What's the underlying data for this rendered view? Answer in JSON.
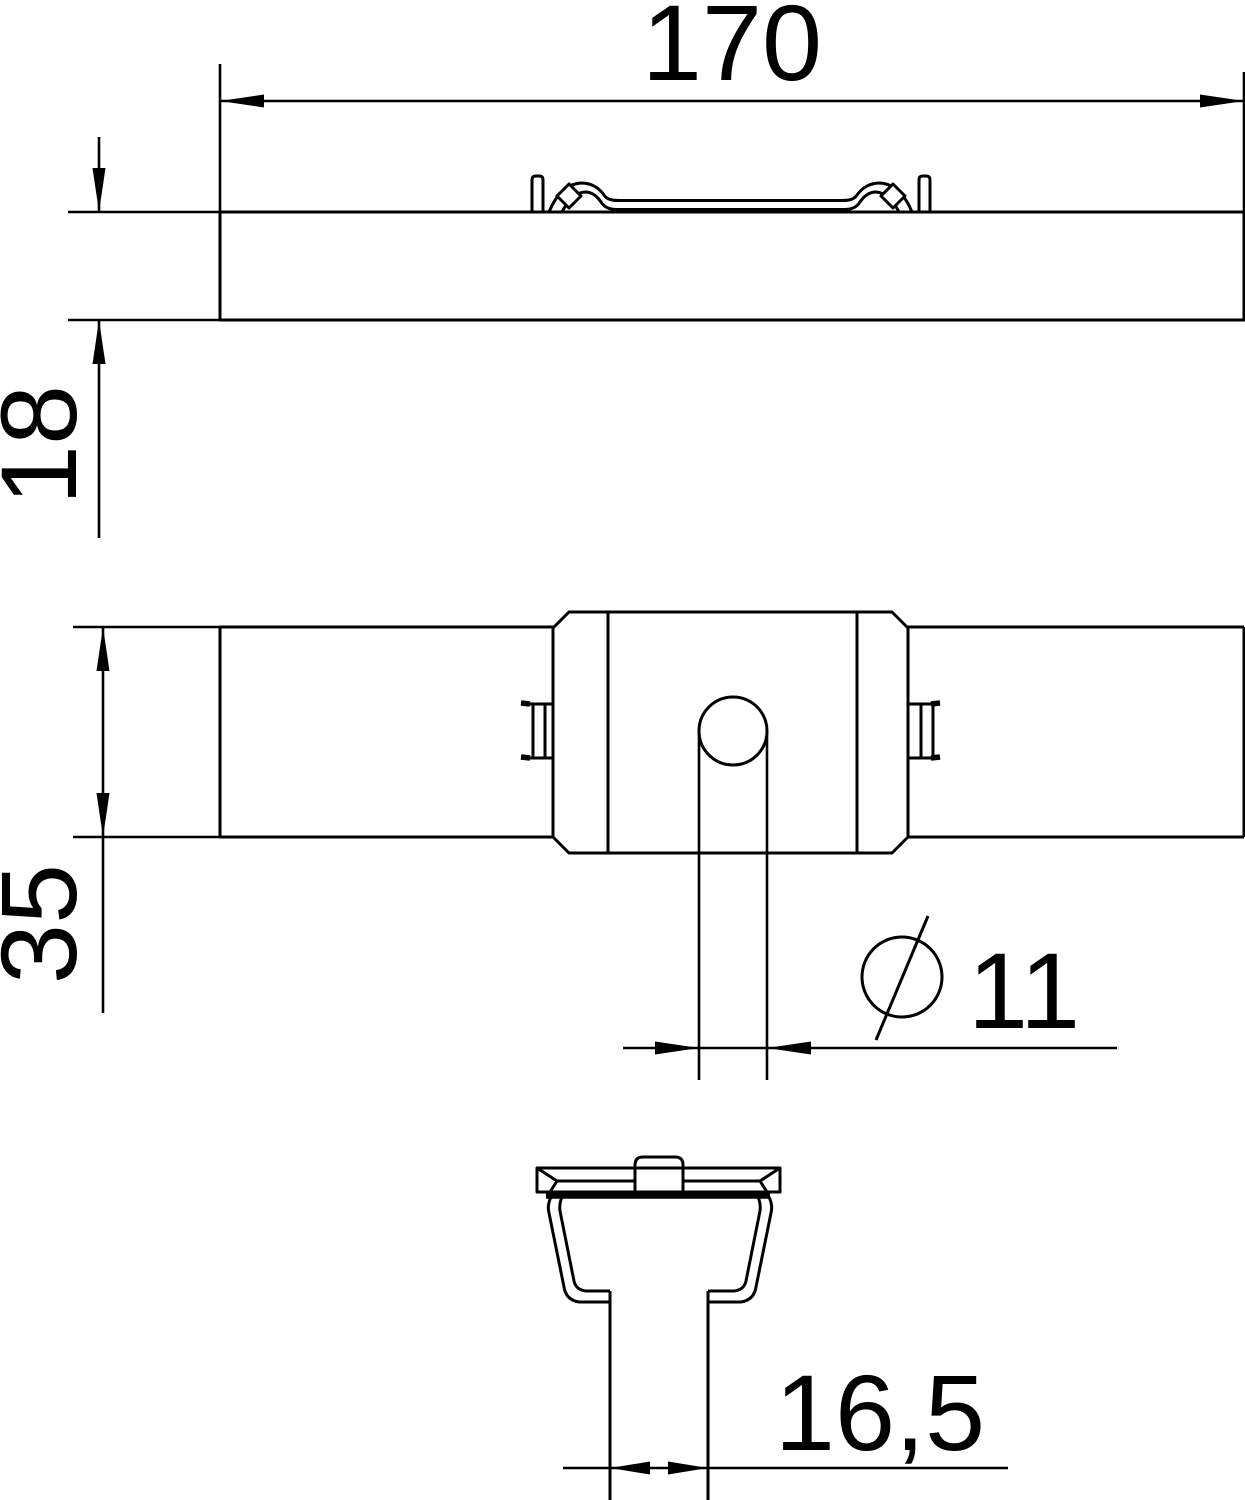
{
  "drawing": {
    "type": "technical-dimension-drawing",
    "colors": {
      "background": "#ffffff",
      "line": "#000000"
    },
    "labels": {
      "length": "170",
      "height": "18",
      "depth": "35",
      "hole_diameter": "11",
      "hole_diameter_symbol": "diameter-circle-with-slash",
      "stem_width": "16,5"
    }
  }
}
